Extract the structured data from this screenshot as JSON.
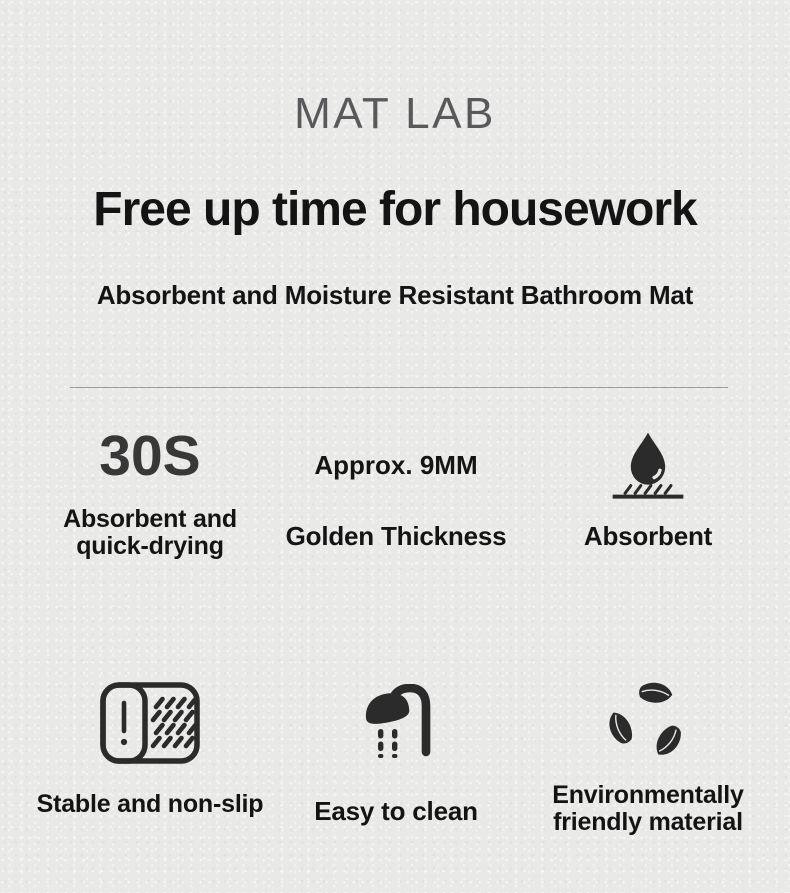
{
  "header": {
    "brand": "MAT LAB",
    "headline": "Free up time for housework",
    "subheadline": "Absorbent and Moisture Resistant Bathroom Mat"
  },
  "features": {
    "quick_drying": {
      "stat": "30S",
      "label": "Absorbent and\nquick-drying"
    },
    "thickness": {
      "stat": "Approx. 9MM",
      "label": "Golden Thickness"
    },
    "absorbent": {
      "icon": "water-drop-icon",
      "label": "Absorbent"
    },
    "non_slip": {
      "icon": "bath-mat-icon",
      "label": "Stable and non-slip"
    },
    "easy_clean": {
      "icon": "shower-head-icon",
      "label": "Easy to clean"
    },
    "eco": {
      "icon": "recycle-leaves-icon",
      "label": "Environmentally\nfriendly material"
    }
  },
  "colors": {
    "background": "#e9e9e8",
    "text_primary": "#141414",
    "brand_gray": "#58595b",
    "stat_gray": "#383838",
    "divider": "#9b9b9b",
    "icon_dark": "#2b2b2b"
  }
}
